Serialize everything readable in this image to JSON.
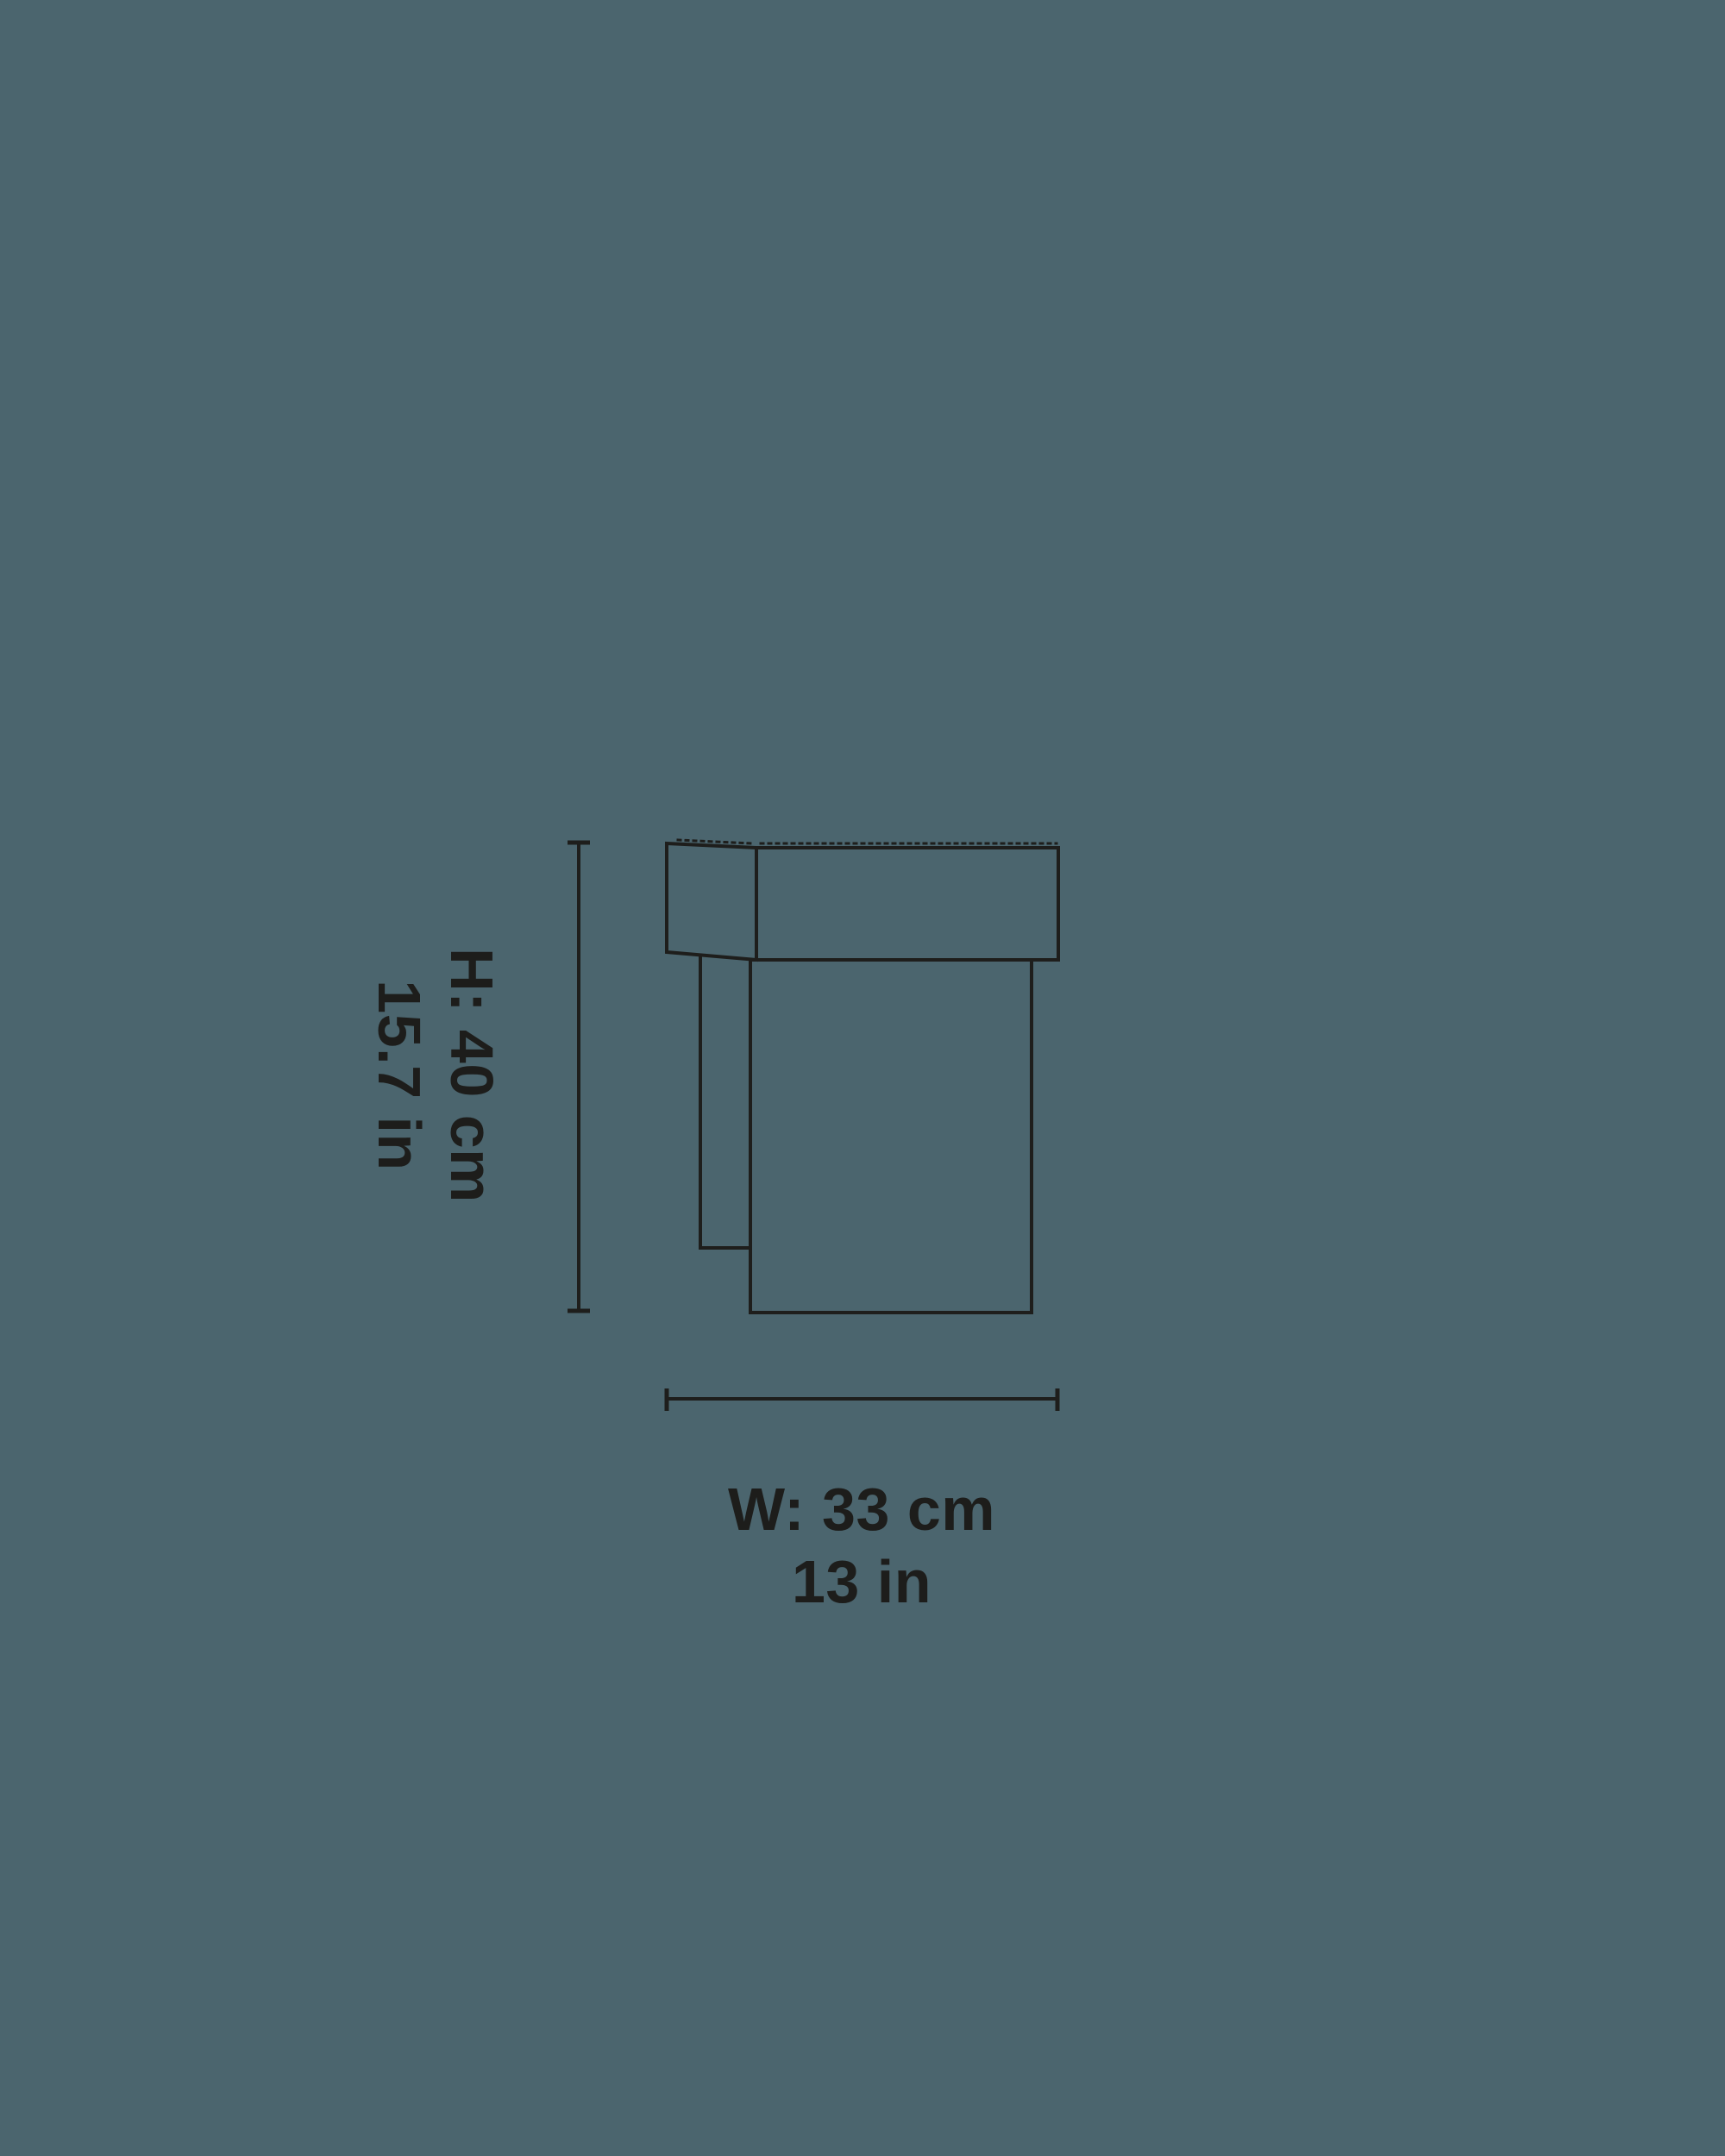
{
  "colors": {
    "background": "#4B656E",
    "line": "#1E1E1C",
    "text": "#1D1D1B"
  },
  "dimensions": {
    "height": {
      "line1": "H: 40 cm",
      "line2": "15.7 in"
    },
    "width": {
      "line1": "W: 33 cm",
      "line2": "13 in"
    }
  }
}
